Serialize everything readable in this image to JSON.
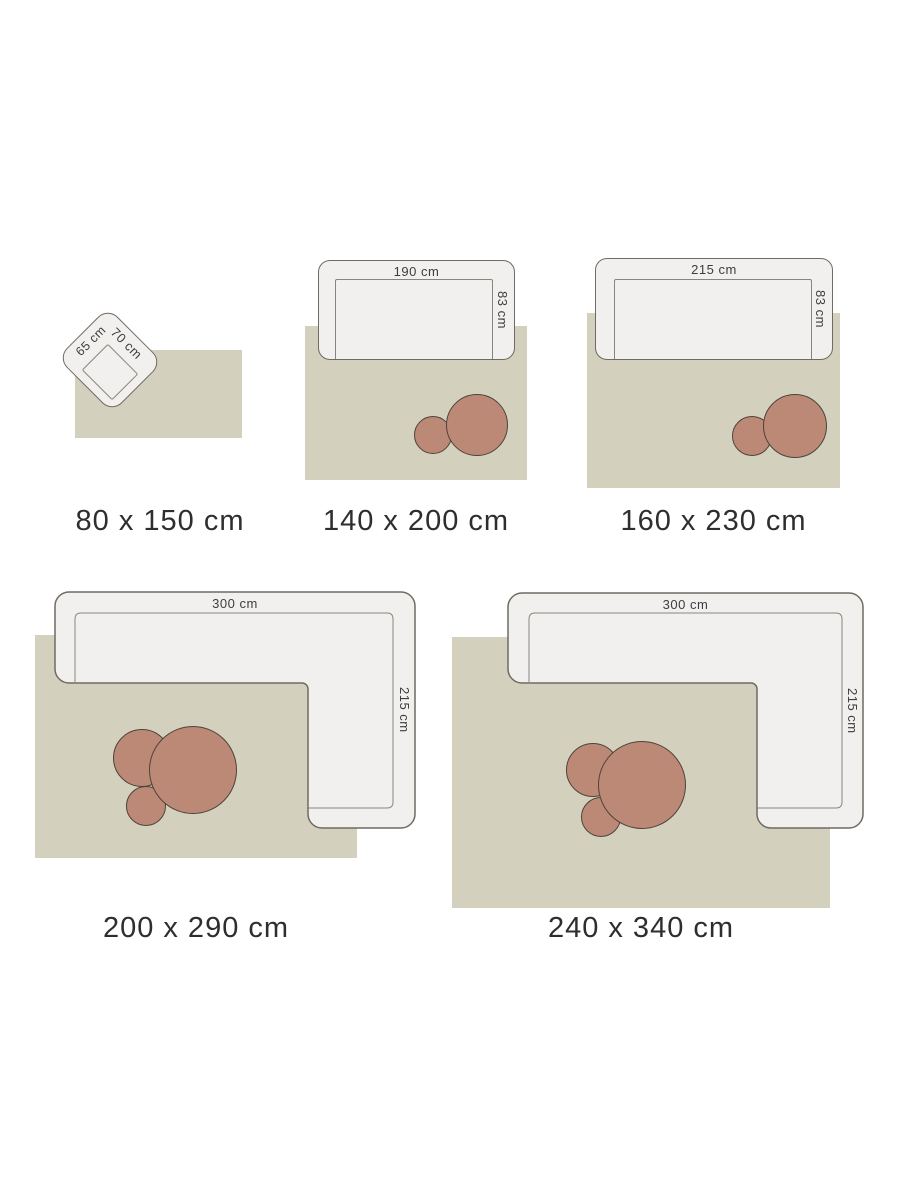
{
  "title": "rug-size-guide",
  "colors": {
    "background": "#ffffff",
    "rug": "#d3d0be",
    "furniture_fill": "#f1f0ee",
    "furniture_outline": "#6f6a62",
    "seat_line": "#8a857c",
    "table_fill": "#bd8977",
    "table_outline": "#4d4339",
    "dimension_text": "#3d3d3d",
    "caption_text": "#2e2e2e"
  },
  "diagrams": [
    {
      "id": "rug-80x150",
      "caption": "80 x 150 cm",
      "furniture": "armchair",
      "tables_count": 0,
      "labels": {
        "width": "65 cm",
        "depth": "70 cm"
      }
    },
    {
      "id": "rug-140x200",
      "caption": "140 x 200 cm",
      "furniture": "sofa",
      "tables_count": 2,
      "labels": {
        "width": "190 cm",
        "depth": "83 cm"
      }
    },
    {
      "id": "rug-160x230",
      "caption": "160 x 230 cm",
      "furniture": "sofa",
      "tables_count": 2,
      "labels": {
        "width": "215 cm",
        "depth": "83 cm"
      }
    },
    {
      "id": "rug-200x290",
      "caption": "200 x 290 cm",
      "furniture": "corner-sofa",
      "tables_count": 3,
      "labels": {
        "width": "300 cm",
        "depth": "215 cm"
      }
    },
    {
      "id": "rug-240x340",
      "caption": "240 x 340 cm",
      "furniture": "corner-sofa",
      "tables_count": 3,
      "labels": {
        "width": "300 cm",
        "depth": "215 cm"
      }
    }
  ]
}
